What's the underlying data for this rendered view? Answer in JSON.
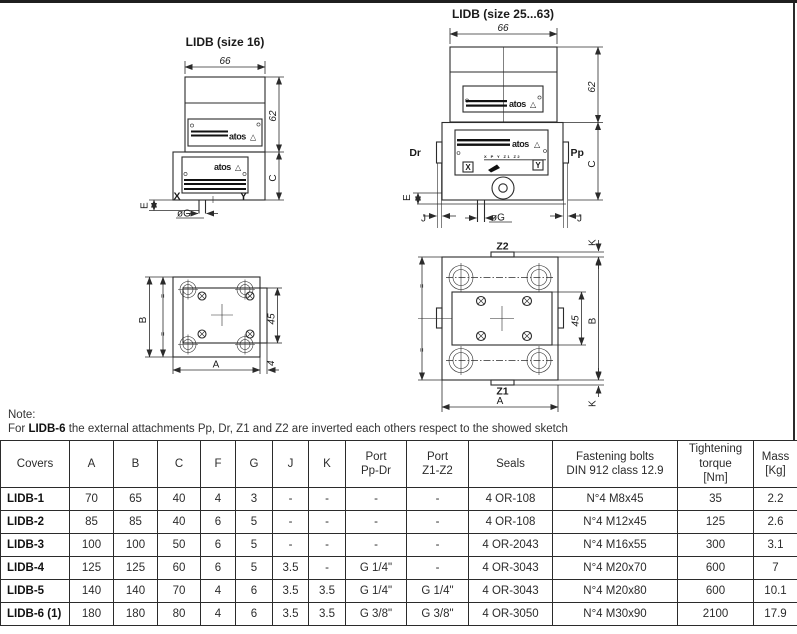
{
  "drawings": {
    "front16_title": "LIDB (size 16)",
    "front2563_title": "LIDB (size 25...63)",
    "labels": {
      "d66": "66",
      "d62": "62",
      "d45": "45",
      "d4": "4",
      "A": "A",
      "B": "B",
      "C": "C",
      "E": "E",
      "J": "J",
      "K": "K",
      "X": "X",
      "Y": "Y",
      "Dr": "Dr",
      "Pp": "Pp",
      "Z1": "Z1",
      "Z2": "Z2",
      "phiG": "øG",
      "atos": "atos",
      "triangle": "△",
      "ports_row": "X P Y Z1 Z2",
      "eq": "="
    }
  },
  "note": {
    "label": "Note:",
    "text_prefix": "For ",
    "text_bold": "LIDB-6",
    "text_suffix": " the external attachments Pp, Dr, Z1 and Z2 are inverted each others respect to the showed sketch"
  },
  "table": {
    "headers": [
      "Covers",
      "A",
      "B",
      "C",
      "F",
      "G",
      "J",
      "K",
      "Port\nPp-Dr",
      "Port\nZ1-Z2",
      "Seals",
      "Fastening bolts\nDIN 912 class 12.9",
      "Tightening\ntorque\n[Nm]",
      "Mass\n[Kg]"
    ],
    "rows": [
      {
        "cover": "LIDB-1",
        "values": [
          "70",
          "65",
          "40",
          "4",
          "3",
          "-",
          "-",
          "-",
          "-",
          "4 OR-108",
          "N°4 M8x45",
          "35",
          "2.2"
        ]
      },
      {
        "cover": "LIDB-2",
        "values": [
          "85",
          "85",
          "40",
          "6",
          "5",
          "-",
          "-",
          "-",
          "-",
          "4 OR-108",
          "N°4 M12x45",
          "125",
          "2.6"
        ]
      },
      {
        "cover": "LIDB-3",
        "values": [
          "100",
          "100",
          "50",
          "6",
          "5",
          "-",
          "-",
          "-",
          "-",
          "4 OR-2043",
          "N°4 M16x55",
          "300",
          "3.1"
        ]
      },
      {
        "cover": "LIDB-4",
        "values": [
          "125",
          "125",
          "60",
          "6",
          "5",
          "3.5",
          "-",
          "G 1/4\"",
          "-",
          "4 OR-3043",
          "N°4 M20x70",
          "600",
          "7"
        ]
      },
      {
        "cover": "LIDB-5",
        "values": [
          "140",
          "140",
          "70",
          "4",
          "6",
          "3.5",
          "3.5",
          "G 1/4\"",
          "G 1/4\"",
          "4 OR-3043",
          "N°4 M20x80",
          "600",
          "10.1"
        ]
      },
      {
        "cover": "LIDB-6 (1)",
        "values": [
          "180",
          "180",
          "80",
          "4",
          "6",
          "3.5",
          "3.5",
          "G 3/8\"",
          "G 3/8\"",
          "4 OR-3050",
          "N°4 M30x90",
          "2100",
          "17.9"
        ]
      }
    ]
  }
}
